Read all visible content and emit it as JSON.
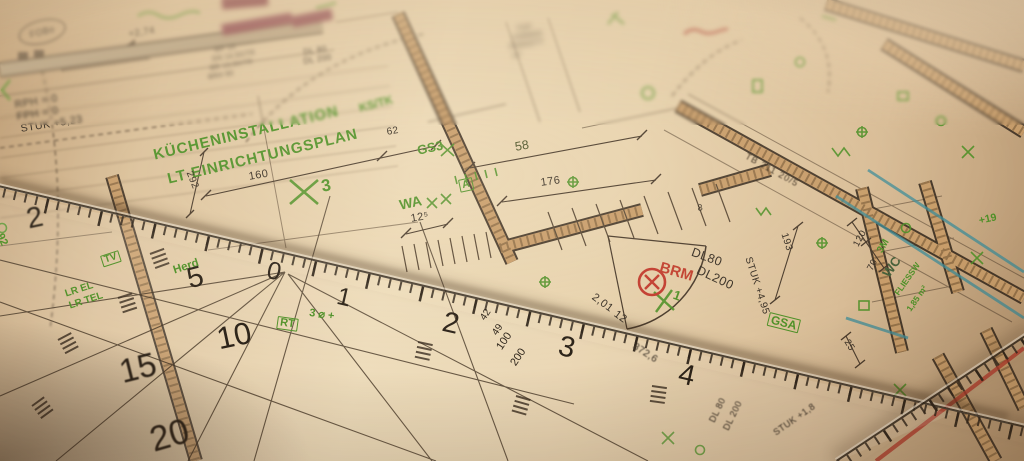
{
  "plan": {
    "stamp_oval": "FOBo",
    "level_note": "+2,74",
    "notes_left": [
      "RPH = 0",
      "FPH = 0",
      "STUK +5,23"
    ],
    "title": [
      "KÜCHENINSTALLATION",
      "LT EINRICHTUNGSPLAN"
    ],
    "door_labels_top": [
      "DL 80",
      "DL 200"
    ],
    "spec_block": [
      "WF 15",
      "DN 14,50/TR",
      "BR 13,50/TR",
      "BRH 90"
    ],
    "room_block": [
      "TOP",
      "ZIMMER",
      "PARKETT",
      "m²"
    ],
    "stamp_red": "BRM",
    "green_marks": {
      "kstk": "KS/TK",
      "gs3": "GS3",
      "x3": "3",
      "wa": "WA",
      "a_box": "A",
      "gsa": "GSA",
      "x1": "1",
      "herd": "Herd",
      "lr1": "LR EL",
      "lr2": "LR TEL",
      "tv": "TV",
      "n92": "92",
      "rt": "RT",
      "rt_note": "3 ⌀ +",
      "fliessw": "FLIESSW",
      "fliessw_area": "1,85 m²",
      "plus19": "+19",
      "m3": "3M"
    },
    "dims": {
      "d160": "160",
      "d292": "292",
      "d62": "62",
      "d58": "58",
      "d176": "176",
      "d125": "12⁵",
      "d193": "193",
      "stuk495": "STUK +4,95",
      "dl80": "DL80",
      "dl200": "DL200",
      "n201": "2,01",
      "n12": "12",
      "n372": "372,6",
      "tb": "TB 211 20/5",
      "dlv1": "DL 80",
      "dlv2": "DL 200",
      "stuk18": "STUK +1,8",
      "n120": "120",
      "n70": "70",
      "n25": "25",
      "n8": "8",
      "wc": "WC"
    }
  },
  "ruler": {
    "cm": [
      "0",
      "1",
      "2",
      "3",
      "4"
    ],
    "fan": [
      "2",
      "5",
      "10",
      "15",
      "20"
    ],
    "scale_text": [
      "42",
      "49",
      "100",
      "200"
    ]
  }
}
